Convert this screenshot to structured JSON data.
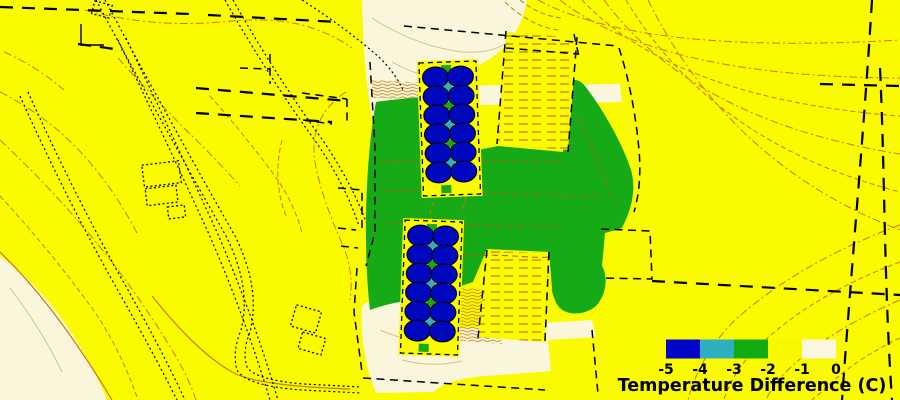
{
  "figure": {
    "kind": "temperature-difference-contour-site-map"
  },
  "legend": {
    "title": "Temperature Difference (C)",
    "tick_labels": [
      "-5",
      "-4",
      "-3",
      "-2",
      "-1",
      "0"
    ],
    "swatches": [
      {
        "range": "-5 to -4",
        "color": "#0006C8"
      },
      {
        "range": "-4 to -3",
        "color": "#2FAEC0"
      },
      {
        "range": "-3 to -2",
        "color": "#12AC12"
      },
      {
        "range": "-2 to -1",
        "color": "#F8F800"
      },
      {
        "range": "-1 to 0",
        "color": "#FBF7DE"
      }
    ]
  },
  "map": {
    "colors": {
      "background": "#FAFA00",
      "cream": "#FAF6DC",
      "green": "#17AA17",
      "tree": "#0008BE",
      "contour": "#C87A00",
      "line": "#000000",
      "teal_accent": "#2FAEC0",
      "orange_accent": "#D4500A",
      "green_accent": "#17AA17"
    },
    "tree_clusters": [
      {
        "id": "north-tree-cluster",
        "rows": 6,
        "cols": 2,
        "tree_count": 12,
        "x": 421,
        "y": 62,
        "rotation": -2
      },
      {
        "id": "south-tree-cluster",
        "rows": 6,
        "cols": 2,
        "tree_count": 12,
        "x": 403,
        "y": 221,
        "rotation": 2
      }
    ]
  },
  "chart_data": {
    "type": "heatmap",
    "title": "Temperature Difference (C)",
    "scale_ticks": [
      -5,
      -4,
      -3,
      -2,
      -1,
      0
    ],
    "scale_colors": [
      "#0006C8",
      "#2FAEC0",
      "#12AC12",
      "#F8F800",
      "#FBF7DE"
    ],
    "legend_position": "bottom-right",
    "regions": [
      {
        "name": "background-field",
        "value_range": [
          -2,
          -1
        ]
      },
      {
        "name": "central-green-zone",
        "value_range": [
          -3,
          -2
        ]
      },
      {
        "name": "cream-zones",
        "value_range": [
          -1,
          0
        ]
      }
    ]
  }
}
